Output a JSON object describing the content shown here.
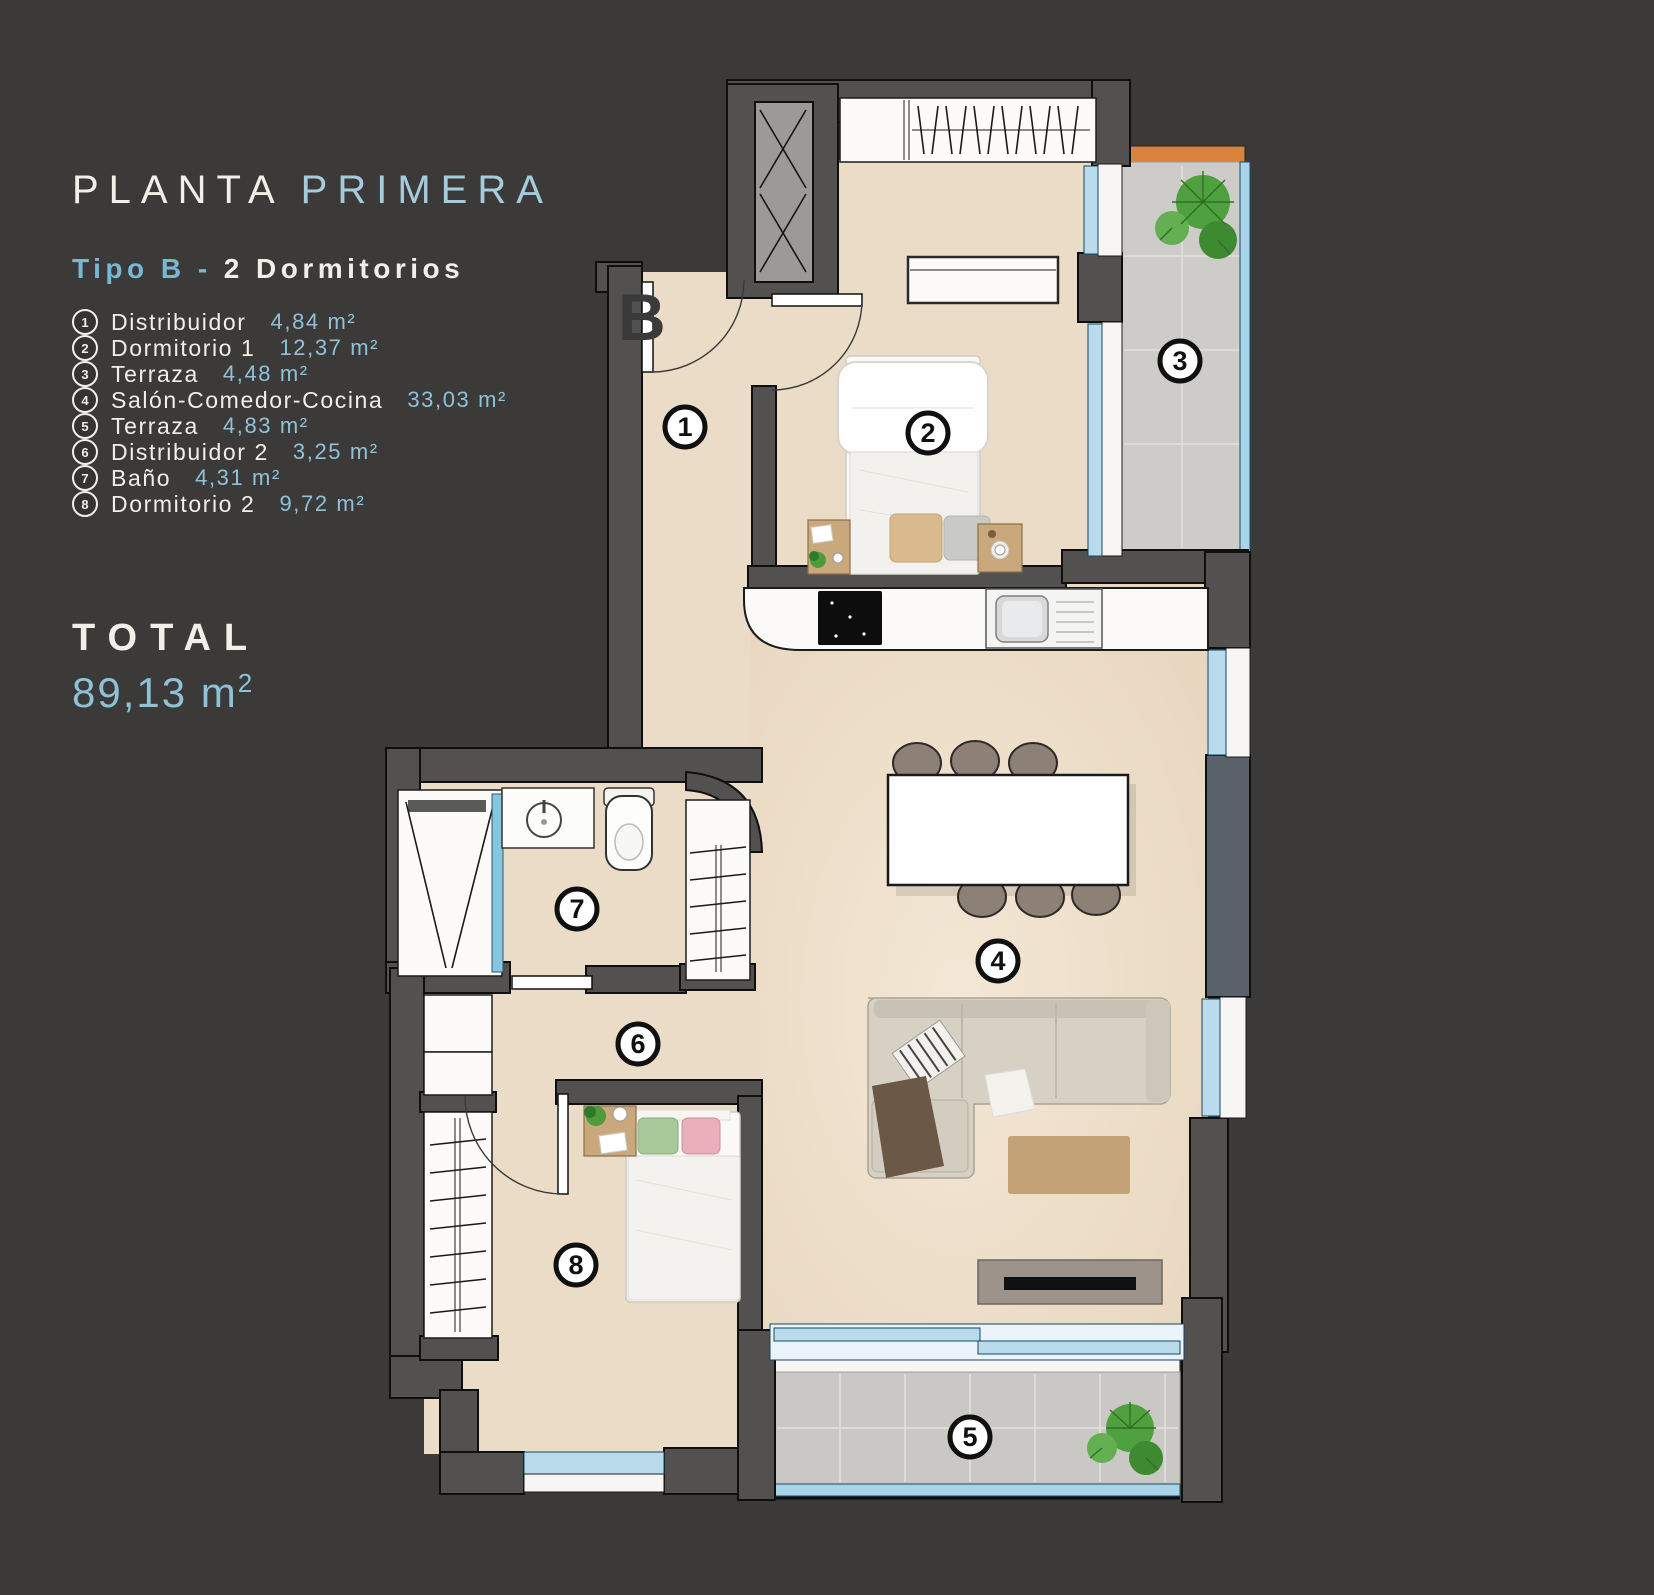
{
  "header": {
    "title_primary": "PLANTA",
    "title_secondary": "PRIMERA",
    "subtitle_primary": "Tipo B -",
    "subtitle_secondary": "2 Dormitorios"
  },
  "legend": {
    "items": [
      {
        "num": "1",
        "label": "Distribuidor",
        "area": "4,84 m²"
      },
      {
        "num": "2",
        "label": "Dormitorio 1",
        "area": "12,37 m²"
      },
      {
        "num": "3",
        "label": "Terraza",
        "area": "4,48 m²"
      },
      {
        "num": "4",
        "label": "Salón-Comedor-Cocina",
        "area": "33,03 m²"
      },
      {
        "num": "5",
        "label": "Terraza",
        "area": "4,83 m²"
      },
      {
        "num": "6",
        "label": "Distribuidor 2",
        "area": "3,25 m²"
      },
      {
        "num": "7",
        "label": "Baño",
        "area": "4,31 m²"
      },
      {
        "num": "8",
        "label": "Dormitorio 2",
        "area": "9,72 m²"
      }
    ]
  },
  "total": {
    "label": "TOTAL",
    "value": "89,13 m",
    "sup": "2"
  },
  "plan": {
    "entrance_label": "B",
    "markers": [
      {
        "n": "1"
      },
      {
        "n": "2"
      },
      {
        "n": "3"
      },
      {
        "n": "4"
      },
      {
        "n": "5"
      },
      {
        "n": "6"
      },
      {
        "n": "7"
      },
      {
        "n": "8"
      }
    ]
  },
  "colors": {
    "background": "#3B3A38",
    "wall": "#525150",
    "floor": "#EADCC7",
    "terrace_tile": "#CDCCC8",
    "glass": "#B9DBEC",
    "balustrade": "#A9D3E7",
    "wood_deck": "#D8843E",
    "accent_blue": "#8FC2D8",
    "text_light": "#F2EFE9"
  }
}
